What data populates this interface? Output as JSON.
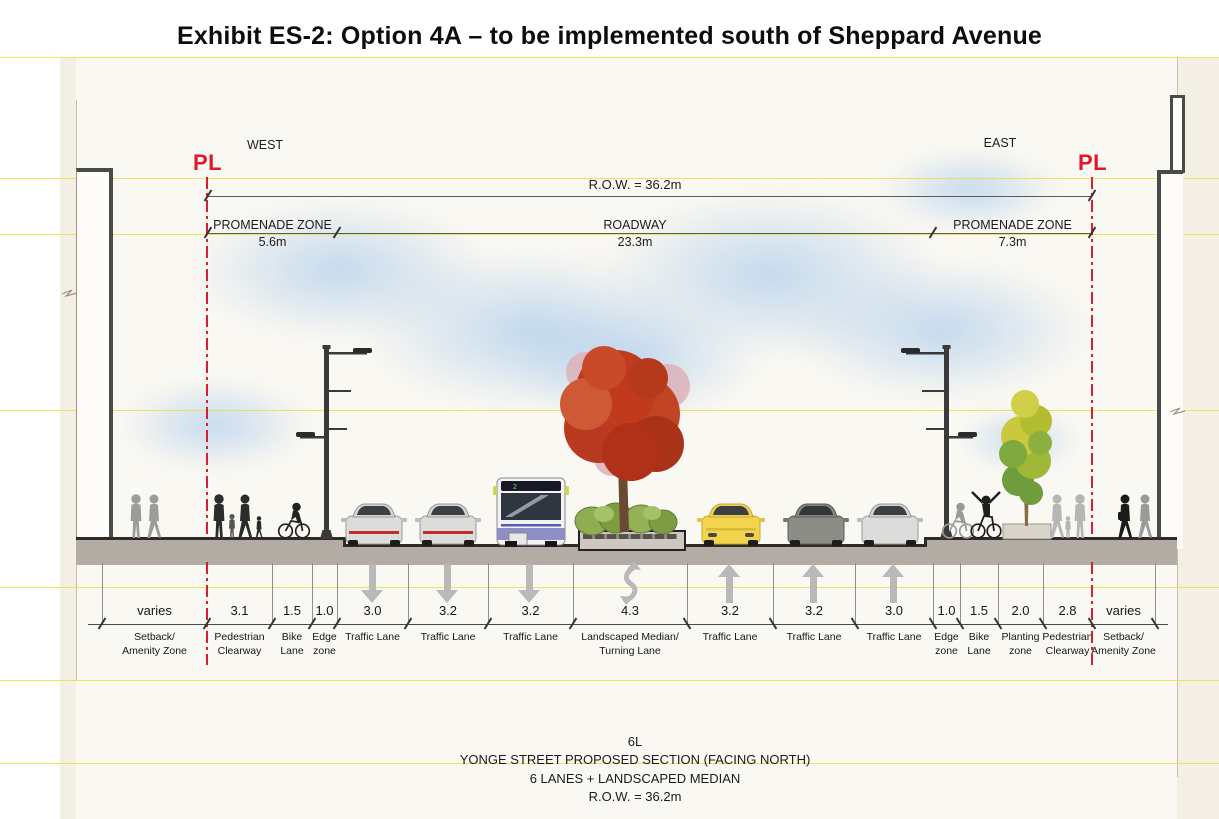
{
  "title": "Exhibit ES-2: Option 4A – to be implemented south of Sheppard Avenue",
  "orientation": {
    "west": "WEST",
    "east": "EAST"
  },
  "property_line": {
    "label": "PL",
    "color": "#e0182b"
  },
  "dimensions": {
    "row": {
      "label": "R.O.W. =  36.2m",
      "x1": 208,
      "x2": 1092,
      "y": 196
    },
    "zone_line_y": 233,
    "zones": [
      {
        "name": "PROMENADE ZONE",
        "width": "5.6m",
        "x1": 208,
        "x2": 337
      },
      {
        "name": "ROADWAY",
        "width": "23.3m",
        "x1": 337,
        "x2": 933
      },
      {
        "name": "PROMENADE ZONE",
        "width": "7.3m",
        "x1": 933,
        "x2": 1092
      }
    ]
  },
  "lanes": [
    {
      "width": "varies",
      "label": "Setback/\nAmenity Zone",
      "x1": 102,
      "x2": 207
    },
    {
      "width": "3.1",
      "label": "Pedestrian\nClearway",
      "x1": 207,
      "x2": 272
    },
    {
      "width": "1.5",
      "label": "Bike\nLane",
      "x1": 272,
      "x2": 312
    },
    {
      "width": "1.0",
      "label": "Edge\nzone",
      "x1": 312,
      "x2": 337
    },
    {
      "width": "3.0",
      "label": "Traffic Lane",
      "x1": 337,
      "x2": 408
    },
    {
      "width": "3.2",
      "label": "Traffic Lane",
      "x1": 408,
      "x2": 488
    },
    {
      "width": "3.2",
      "label": "Traffic Lane",
      "x1": 488,
      "x2": 573
    },
    {
      "width": "4.3",
      "label": "Landscaped Median/\nTurning Lane",
      "x1": 573,
      "x2": 687
    },
    {
      "width": "3.2",
      "label": "Traffic Lane",
      "x1": 687,
      "x2": 773
    },
    {
      "width": "3.2",
      "label": "Traffic Lane",
      "x1": 773,
      "x2": 855
    },
    {
      "width": "3.0",
      "label": "Traffic Lane",
      "x1": 855,
      "x2": 933
    },
    {
      "width": "1.0",
      "label": "Edge\nzone",
      "x1": 933,
      "x2": 960
    },
    {
      "width": "1.5",
      "label": "Bike\nLane",
      "x1": 960,
      "x2": 998
    },
    {
      "width": "2.0",
      "label": "Planting\nzone",
      "x1": 998,
      "x2": 1043
    },
    {
      "width": "2.8",
      "label": "Pedestrian\nClearway",
      "x1": 1043,
      "x2": 1092
    },
    {
      "width": "varies",
      "label": "Setback/\nAmenity Zone",
      "x1": 1092,
      "x2": 1155
    }
  ],
  "arrows": [
    {
      "x": 373,
      "dir": "down"
    },
    {
      "x": 448,
      "dir": "down"
    },
    {
      "x": 530,
      "dir": "down"
    },
    {
      "x": 630,
      "dir": "two-way"
    },
    {
      "x": 730,
      "dir": "up"
    },
    {
      "x": 814,
      "dir": "up"
    },
    {
      "x": 894,
      "dir": "up"
    }
  ],
  "caption": {
    "l1": "6L",
    "l2": "YONGE STREET PROPOSED SECTION (FACING NORTH)",
    "l3": "6 LANES + LANDSCAPED MEDIAN",
    "l4": "R.O.W. = 36.2m"
  },
  "colors": {
    "property_line": "#e0182b",
    "arrow": "#b9b9b9",
    "ground": "#b2aca5",
    "guide_yellow": "#eae13f",
    "red_tree": "#bb3a1f",
    "bus_stripe": "#8f8fc8",
    "yellow_car": "#f2d44e"
  }
}
